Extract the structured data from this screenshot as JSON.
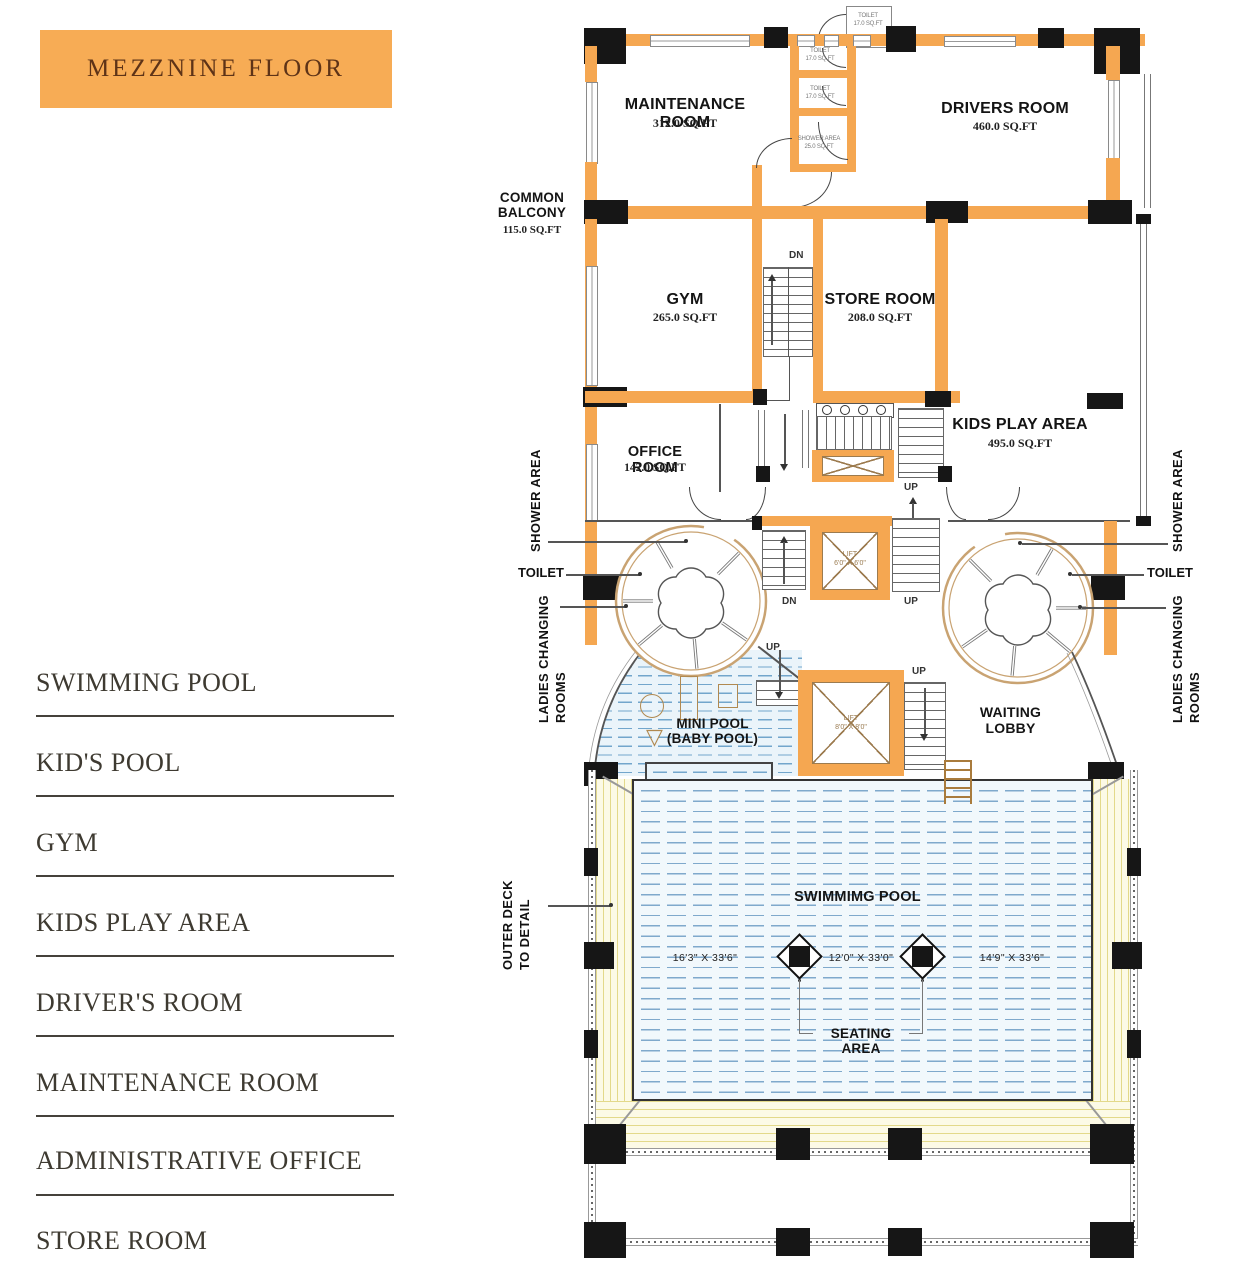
{
  "title": "MEZZNINE FLOOR",
  "legend": {
    "items": [
      "SWIMMING POOL",
      "KID'S POOL",
      "GYM",
      "KIDS PLAY AREA",
      "DRIVER'S ROOM",
      "MAINTENANCE ROOM",
      "ADMINISTRATIVE OFFICE",
      "STORE ROOM"
    ]
  },
  "plan": {
    "rooms": {
      "maintenance": {
        "name": "MAINTENANCE ROOM",
        "area": "312.0 SQ.FT"
      },
      "drivers": {
        "name": "DRIVERS ROOM",
        "area": "460.0 SQ.FT"
      },
      "common_balcony": {
        "name": "COMMON BALCONY",
        "area": "115.0 SQ.FT"
      },
      "gym": {
        "name": "GYM",
        "area": "265.0 SQ.FT"
      },
      "store": {
        "name": "STORE ROOM",
        "area": "208.0 SQ.FT"
      },
      "office": {
        "name": "OFFICE ROOM",
        "area": "142.0 SQ.FT"
      },
      "kids_play": {
        "name": "KIDS PLAY AREA",
        "area": "495.0 SQ.FT"
      },
      "toilet_annex": {
        "name": "TOILET",
        "area": "17.0 SQ.FT"
      },
      "toilet_1": {
        "name": "TOILET",
        "area": "17.0 SQ.FT"
      },
      "toilet_2": {
        "name": "TOILET",
        "area": "17.0 SQ.FT"
      },
      "shower": {
        "name": "SHOWER AREA",
        "area": "25.0 SQ.FT"
      },
      "mini_pool": {
        "name": "MINI POOL",
        "sub": "(BABY POOL)"
      },
      "waiting_lobby": {
        "name": "WAITING LOBBY"
      },
      "swimming_pool": {
        "name": "SWIMMIMG POOL"
      },
      "seating_area": {
        "name": "SEATING AREA"
      }
    },
    "callouts": {
      "shower": "SHOWER AREA",
      "toilet": "TOILET",
      "ladies_line1": "LADIES CHANGING",
      "ladies_line2": "ROOMS",
      "outer_deck_line1": "OUTER DECK",
      "outer_deck_line2": "TO DETAIL"
    },
    "lifts": {
      "small": {
        "name": "LIFT",
        "size": "6'0\" X 6'0\""
      },
      "large": {
        "name": "LIFT",
        "size": "8'0\" X 8'0\""
      }
    },
    "stairs": {
      "up": "UP",
      "dn": "DN"
    },
    "pool_dims": [
      "16'3\" X 33'6\"",
      "12'0\" X 33'0\"",
      "14'9\" X 33'6\""
    ],
    "icons": {
      "baby_pool_triangle": "▽"
    }
  },
  "colors": {
    "wall": "#F5A751",
    "column": "#161616",
    "title_bg": "#F7AC55",
    "title_text": "#5E3317",
    "water_line": "#7FA9CC",
    "deck_line": "#E3D98A",
    "ring": "#C9A372",
    "legend_text": "#3E3A31"
  }
}
